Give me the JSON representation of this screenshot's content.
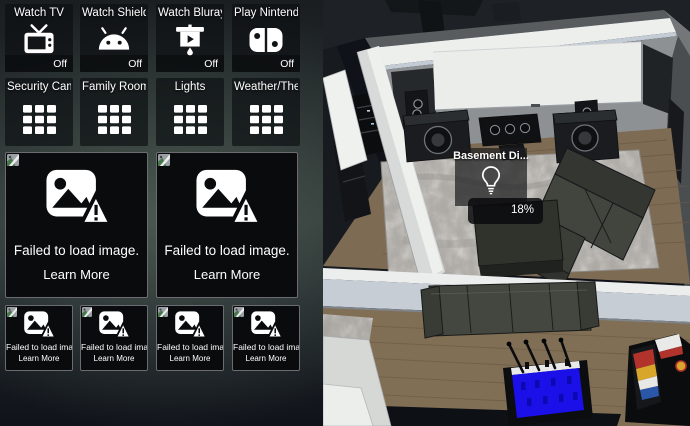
{
  "tiles": {
    "actions": [
      {
        "title": "Watch TV",
        "status": "Off",
        "icon": "tv-icon"
      },
      {
        "title": "Watch Shield...",
        "status": "Off",
        "icon": "android-icon"
      },
      {
        "title": "Watch Bluray...",
        "status": "Off",
        "icon": "projector-screen-icon"
      },
      {
        "title": "Play Nintend...",
        "status": "Off",
        "icon": "nintendo-switch-icon"
      }
    ],
    "groups": [
      {
        "title": "Security Cam...",
        "icon": "grid-icon"
      },
      {
        "title": "Family Room ...",
        "icon": "grid-icon"
      },
      {
        "title": "Lights",
        "icon": "grid-icon"
      },
      {
        "title": "Weather/The...",
        "icon": "grid-icon"
      }
    ],
    "failed": {
      "message": "Failed to load image.",
      "learn_more": "Learn More"
    }
  },
  "floorplan": {
    "tooltip": {
      "title": "Basement Di...",
      "value": "18%",
      "icon": "lightbulb-icon"
    }
  },
  "colors": {
    "foosball_blue": "#1b10e8",
    "screen_white": "#ebedeb",
    "rug_gray": "#b4b1ac"
  }
}
